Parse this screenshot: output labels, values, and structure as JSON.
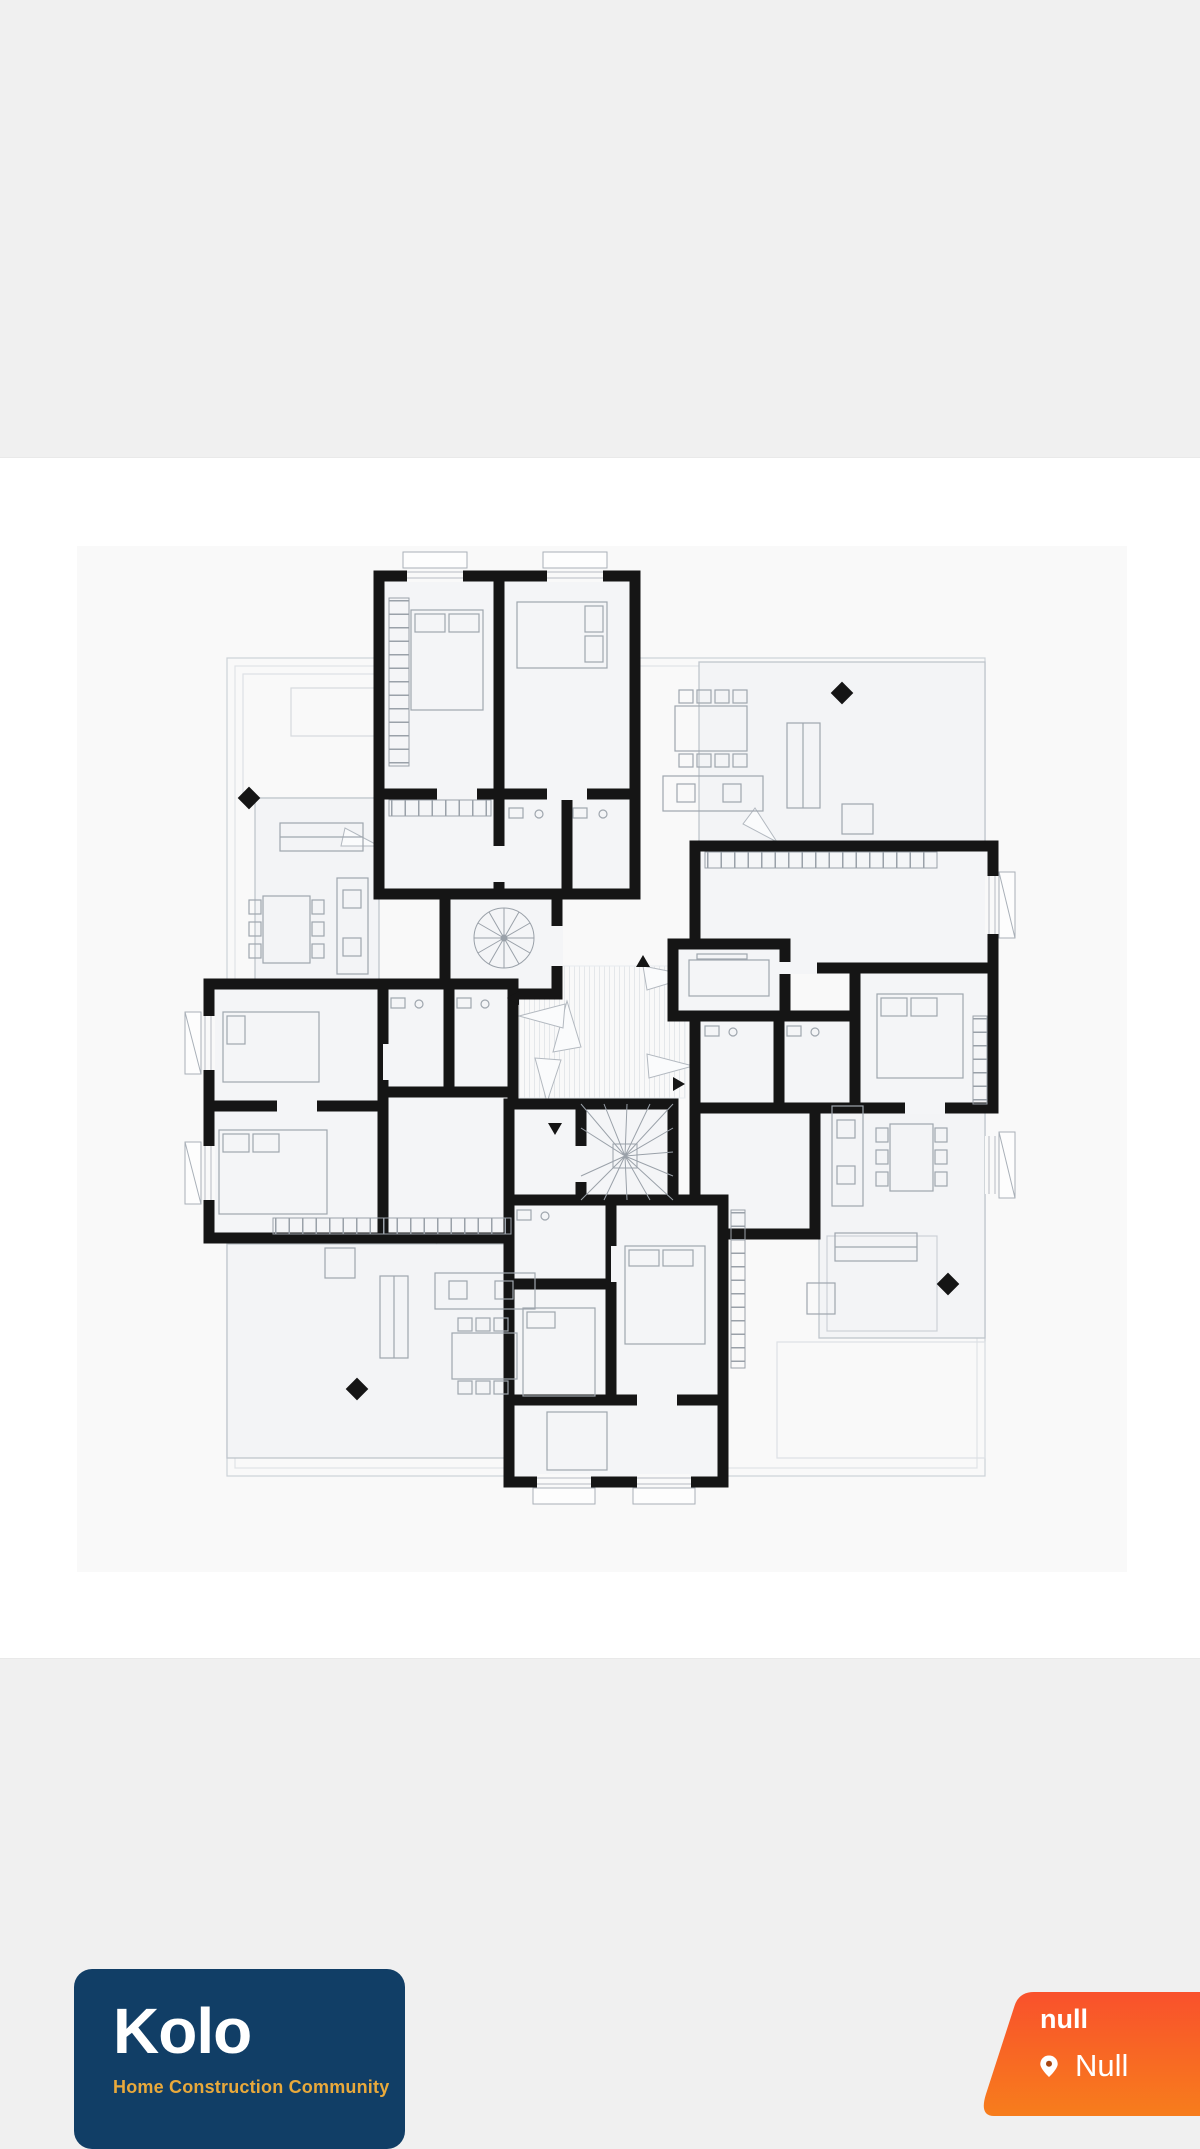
{
  "page": {
    "background_color": "#f0f0f0",
    "band_background_color": "#ffffff",
    "plan_background_color": "#f9f9f9"
  },
  "floor_plan": {
    "alt": "Black-and-white architectural floor plan of an apartment level: four residences arranged pinwheel-style around a central core with a spiral stair and a winder stair, heavy black walls, furniture outlines, door swings, four black diamond markers and four small directional arrows",
    "wall_color": "#151515",
    "line_color": "#a9b0b8"
  },
  "brand_card": {
    "name": "Kolo",
    "tagline": "Home Construction Community",
    "background_color": "#113e66",
    "name_color": "#ffffff",
    "tagline_color": "#e9a93b"
  },
  "location_badge": {
    "title": "null",
    "location": "Null",
    "pin_icon": "map-pin",
    "gradient_top": "#f9512c",
    "gradient_bottom": "#f77d1c",
    "text_color": "#ffffff"
  }
}
